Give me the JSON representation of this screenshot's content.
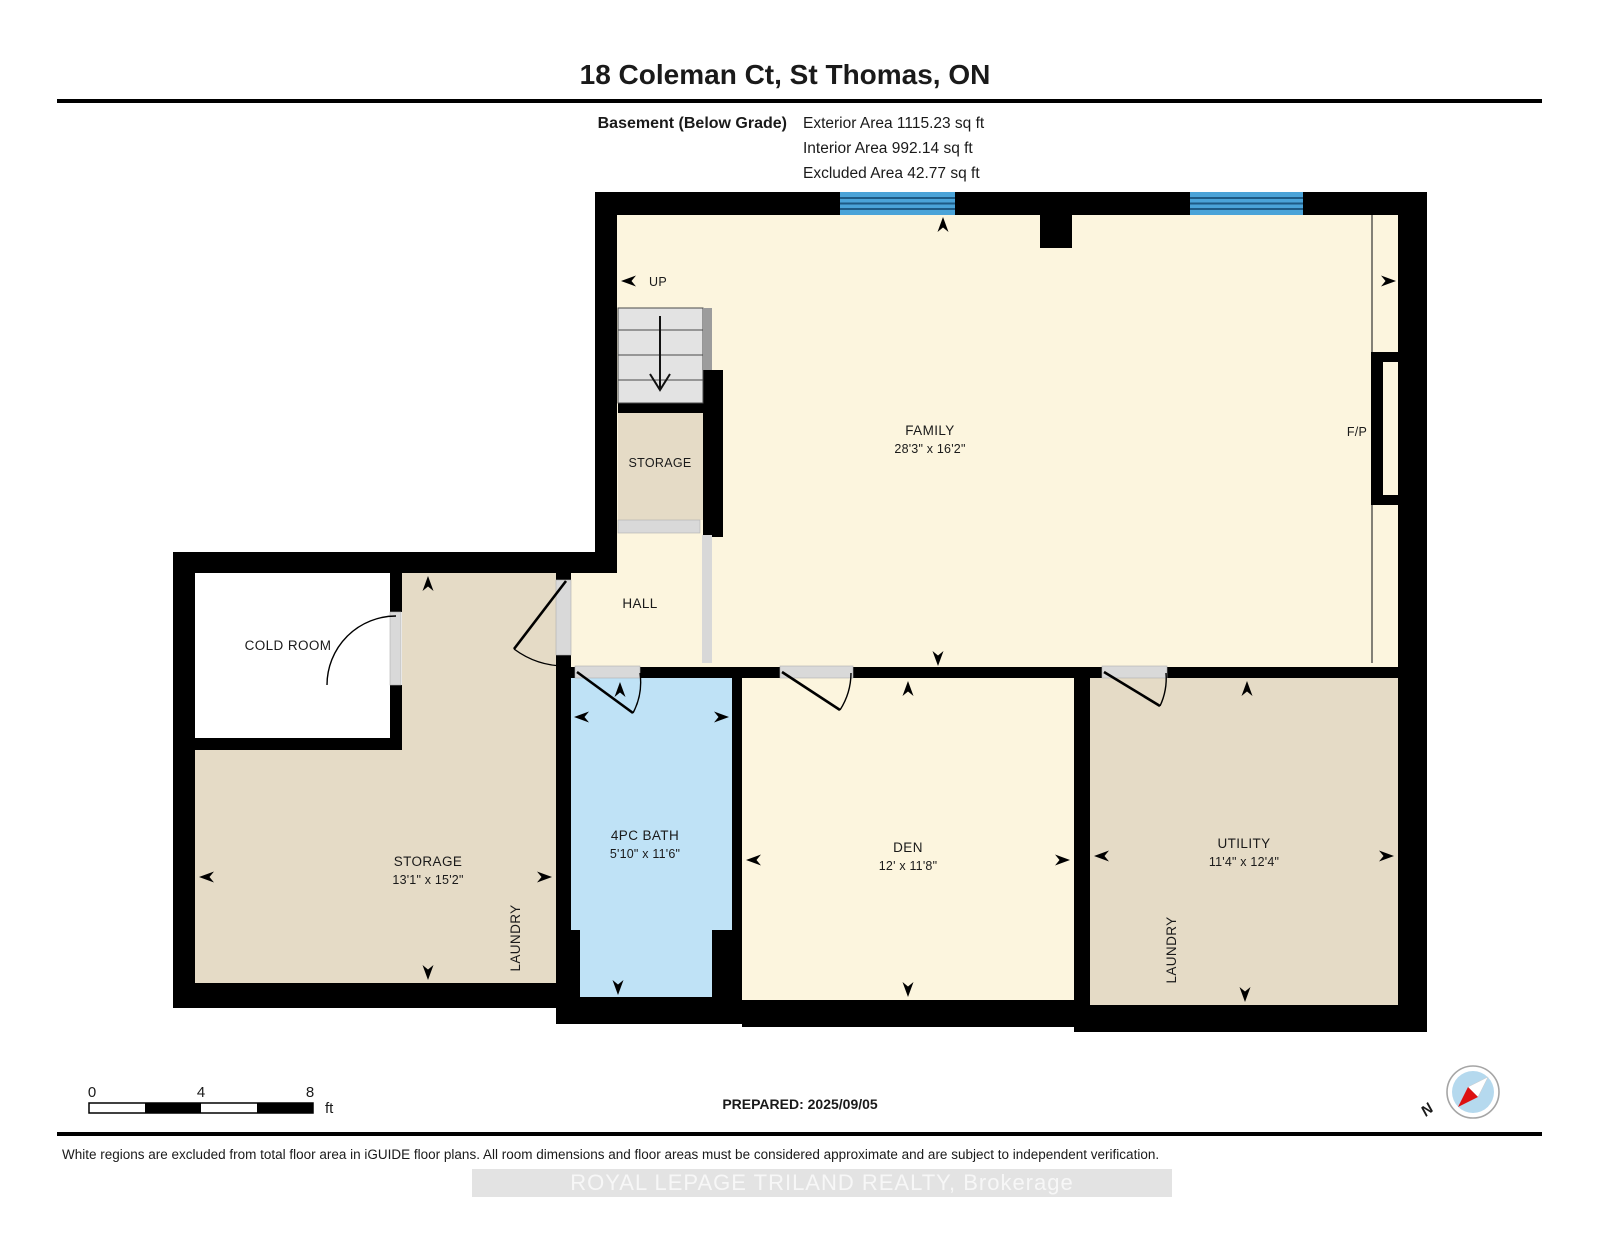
{
  "header": {
    "title": "18 Coleman Ct, St Thomas, ON",
    "floor": "Basement (Below Grade)",
    "exterior": "Exterior Area 1115.23 sq ft",
    "interior": "Interior Area 992.14 sq ft",
    "excluded": "Excluded Area 42.77 sq ft"
  },
  "rooms": {
    "family": {
      "name": "FAMILY",
      "dims": "28'3\" x 16'2\""
    },
    "storage_small": {
      "name": "STORAGE"
    },
    "hall": {
      "name": "HALL"
    },
    "cold_room": {
      "name": "COLD ROOM"
    },
    "storage": {
      "name": "STORAGE",
      "dims": "13'1\" x 15'2\""
    },
    "bath": {
      "name": "4PC BATH",
      "dims": "5'10\" x 11'6\""
    },
    "den": {
      "name": "DEN",
      "dims": "12' x 11'8\""
    },
    "utility": {
      "name": "UTILITY",
      "dims": "11'4\" x 12'4\""
    },
    "laundry_left": {
      "name": "LAUNDRY"
    },
    "laundry_right": {
      "name": "LAUNDRY"
    },
    "fireplace": {
      "name": "F/P"
    },
    "stairs": {
      "name": "UP"
    }
  },
  "scale_bar": {
    "t0": "0",
    "t4": "4",
    "t8": "8",
    "unit": "ft"
  },
  "footer": {
    "prepared": "PREPARED: 2025/09/05",
    "disclaimer": "White regions are excluded from total floor area in iGUIDE floor plans. All room dimensions and floor areas must be considered approximate and are subject to independent verification.",
    "watermark": "ROYAL LEPAGE TRILAND REALTY, Brokerage"
  },
  "compass": {
    "north": "N"
  },
  "colors": {
    "wall": "#000000",
    "floor-cream": "#fcf5de",
    "floor-tan": "#e5dbc6",
    "floor-bath": "#bfe2f6",
    "window-blue": "#4aa3d8",
    "window-line": "#1d5a85",
    "door-gray": "#d9d9d9",
    "stair-gray": "#e3e3e3",
    "compass-blue": "#b5d9ee",
    "needle-red": "#dd1111"
  }
}
